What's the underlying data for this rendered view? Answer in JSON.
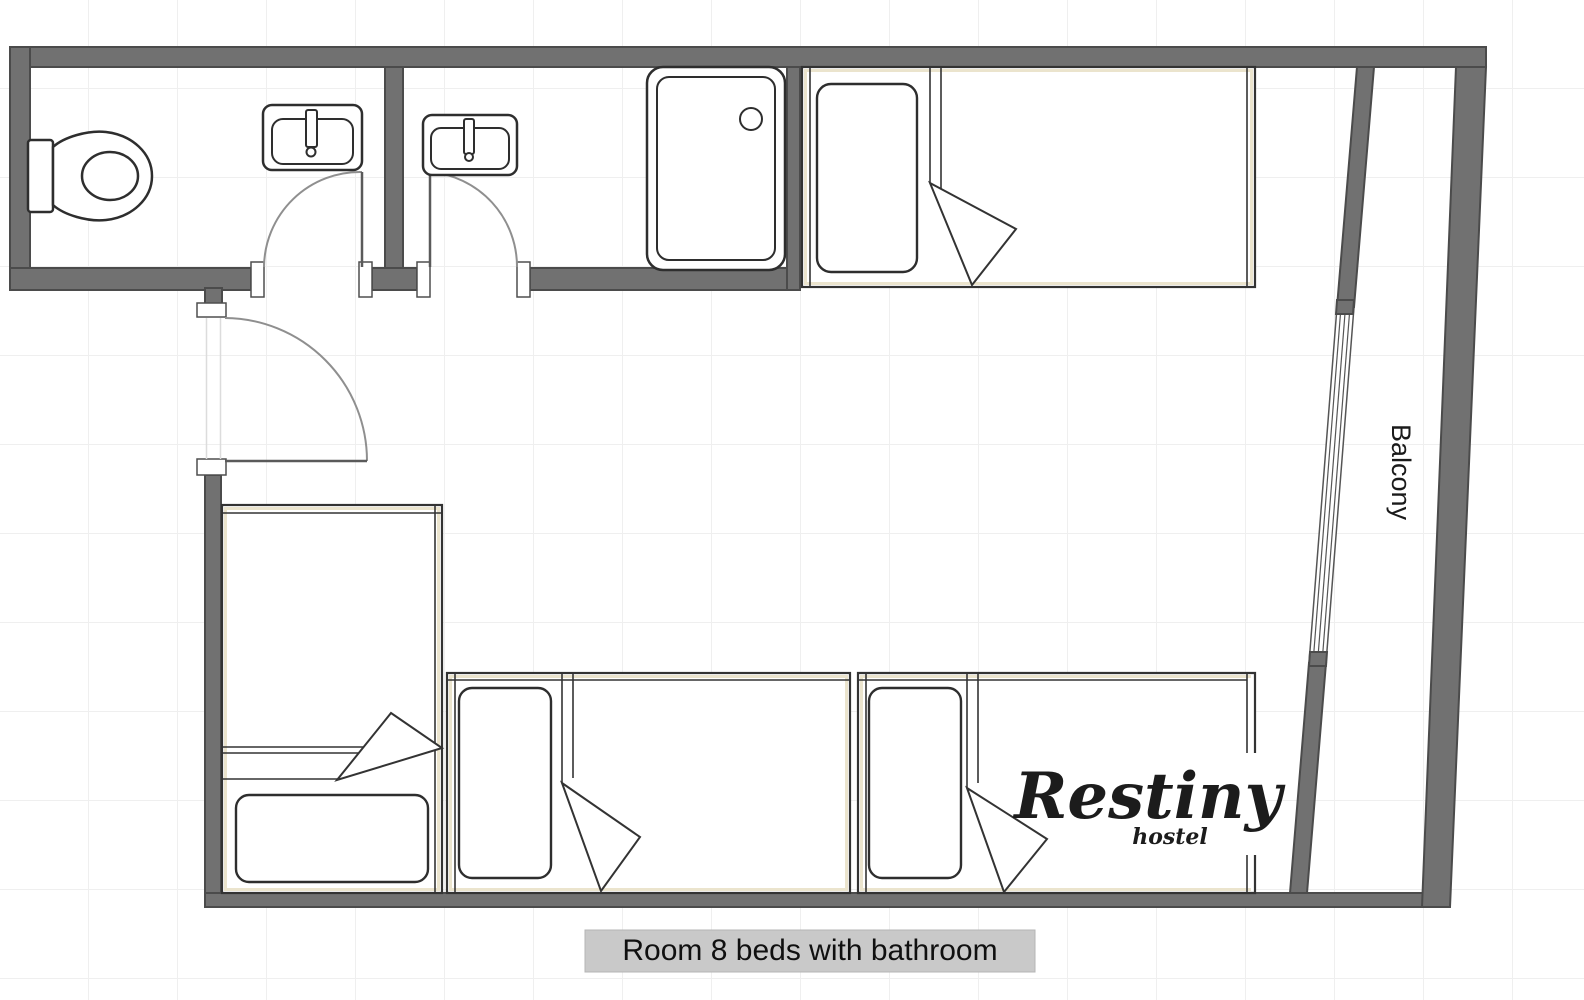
{
  "page": {
    "type": "hostel-room-floor-plan"
  },
  "labels": {
    "balcony": "Balcony",
    "caption": "Room 8 beds with bathroom"
  },
  "logo": {
    "name": "Restiny",
    "sub": "hostel"
  },
  "colors": {
    "wall": "#717171",
    "wall_outline": "#4b4b4b",
    "fixture_line": "#2e2e2e",
    "bed_line": "#333333",
    "bed_accent": "#ebe4cd",
    "door_arc": "#8f8f8f",
    "caption_bg": "#c9c9c9",
    "text": "#141414",
    "grid": "#efefef",
    "background": "#ffffff"
  },
  "icons": {
    "toilet": "toilet-top-view",
    "sink_left": "sink-top-view",
    "sink_right": "sink-top-view",
    "shower": "shower-tray-with-drain",
    "bed_top": "single-bed-top-view",
    "bed_left": "single-bed-top-view",
    "bed_bottom_middle": "single-bed-top-view",
    "bed_bottom_right": "single-bed-top-view",
    "door_bathroom_left": "door-swing-arc",
    "door_bathroom_right": "door-swing-arc",
    "door_entrance": "door-swing-arc",
    "balcony_window": "sliding-window-glazing"
  }
}
